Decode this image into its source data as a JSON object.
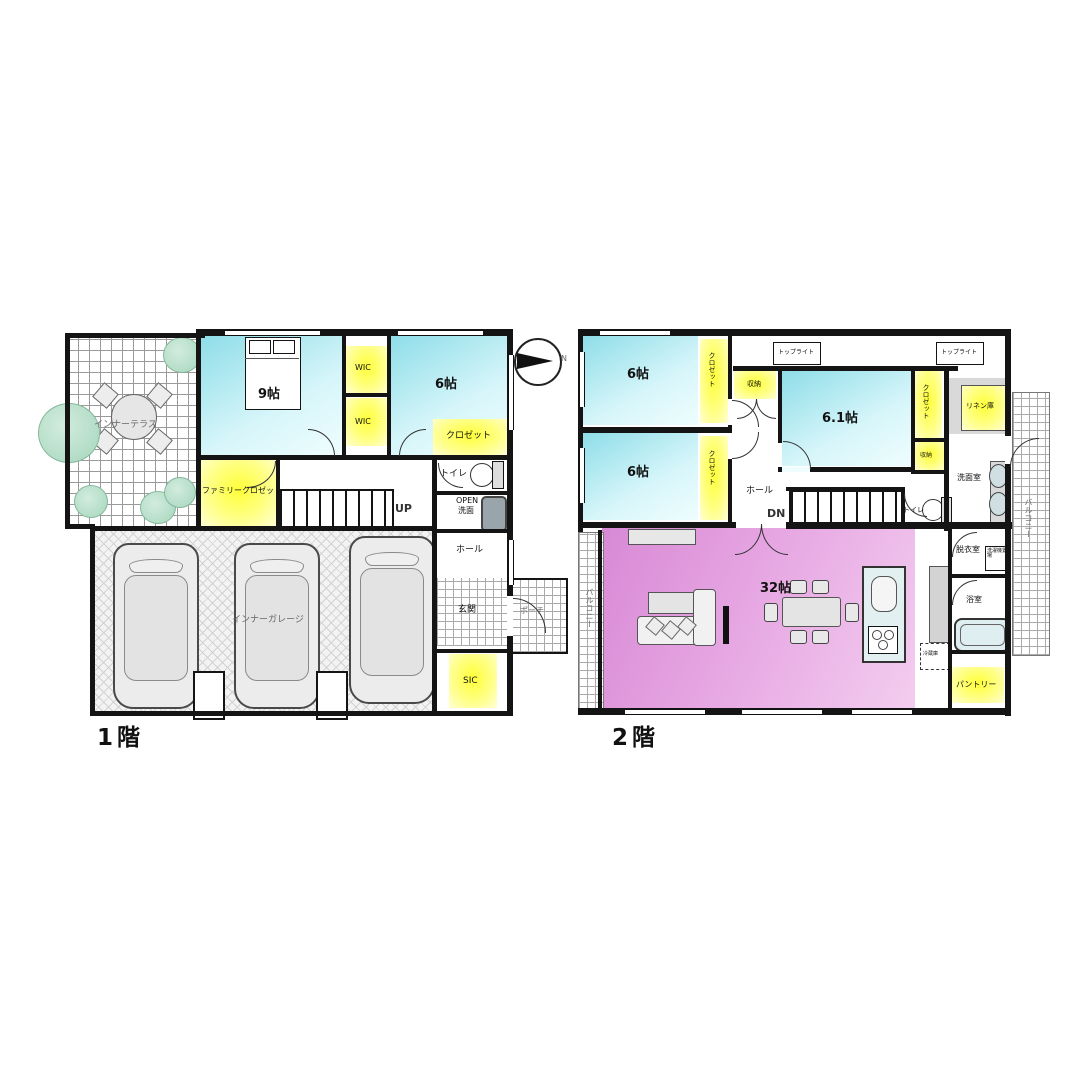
{
  "colors": {
    "room_cyan": "#8edde8",
    "closet_yellow": "#ffff55",
    "ldk_pink": "#e6a6e2",
    "wall": "#141414",
    "tree_green": "#a6d6bd"
  },
  "compass": {
    "north": "N"
  },
  "floor1": {
    "label": "1階",
    "terrace": "インナーテラス",
    "bedroom": "9帖",
    "wic_upper": "WIC",
    "wic_lower": "WIC",
    "room6": "6帖",
    "closet": "クロゼット",
    "family_closet": "ファミリークロゼット",
    "toilet": "トイレ",
    "open_wash_line1": "OPEN",
    "open_wash_line2": "洗面",
    "stairs": "UP",
    "hall": "ホール",
    "entrance": "玄関",
    "porch": "ポーチ",
    "sic": "SIC",
    "garage": "インナーガレージ"
  },
  "floor2": {
    "label": "2階",
    "room6_upper": "6帖",
    "room6_lower": "6帖",
    "closet_upper": "クロゼット",
    "closet_lower": "クロゼット",
    "storage_mid": "収納",
    "toplight_left": "トップライト",
    "toplight_right": "トップライト",
    "room61": "6.1帖",
    "closet_right": "クロゼット",
    "linen": "リネン庫",
    "storage_small": "収納",
    "hall": "ホール",
    "stairs": "DN",
    "toilet": "トイレ",
    "washroom": "洗面室",
    "dressing": "脱衣室",
    "laundry": "洗濯機置場",
    "bath": "浴室",
    "pantry": "パントリー",
    "fridge": "冷蔵庫",
    "ldk": "32帖",
    "balcony_left": "バルコニー",
    "balcony_right": "バルコニー"
  }
}
